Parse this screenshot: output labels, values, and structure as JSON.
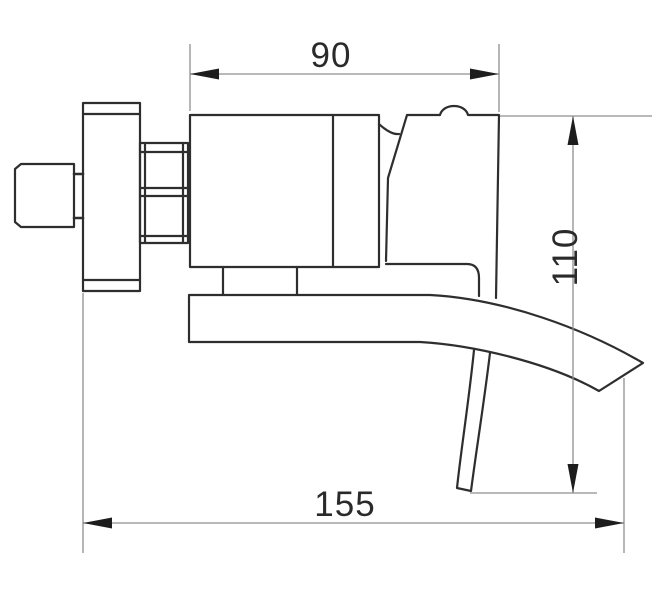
{
  "drawing": {
    "type": "technical-dimension-drawing",
    "subject": "wall-mounted waterfall faucet, side view",
    "colors": {
      "background": "#ffffff",
      "outline": "#2e2e2e",
      "dimension_line": "#8f8f8f",
      "arrow": "#1d1d1d",
      "text": "#2a2a2a"
    },
    "dimensions": {
      "top_width": {
        "value": "90",
        "orientation": "horizontal",
        "position": "top"
      },
      "right_height": {
        "value": "110",
        "orientation": "vertical",
        "position": "right"
      },
      "bottom_length": {
        "value": "155",
        "orientation": "horizontal",
        "position": "bottom"
      }
    }
  }
}
